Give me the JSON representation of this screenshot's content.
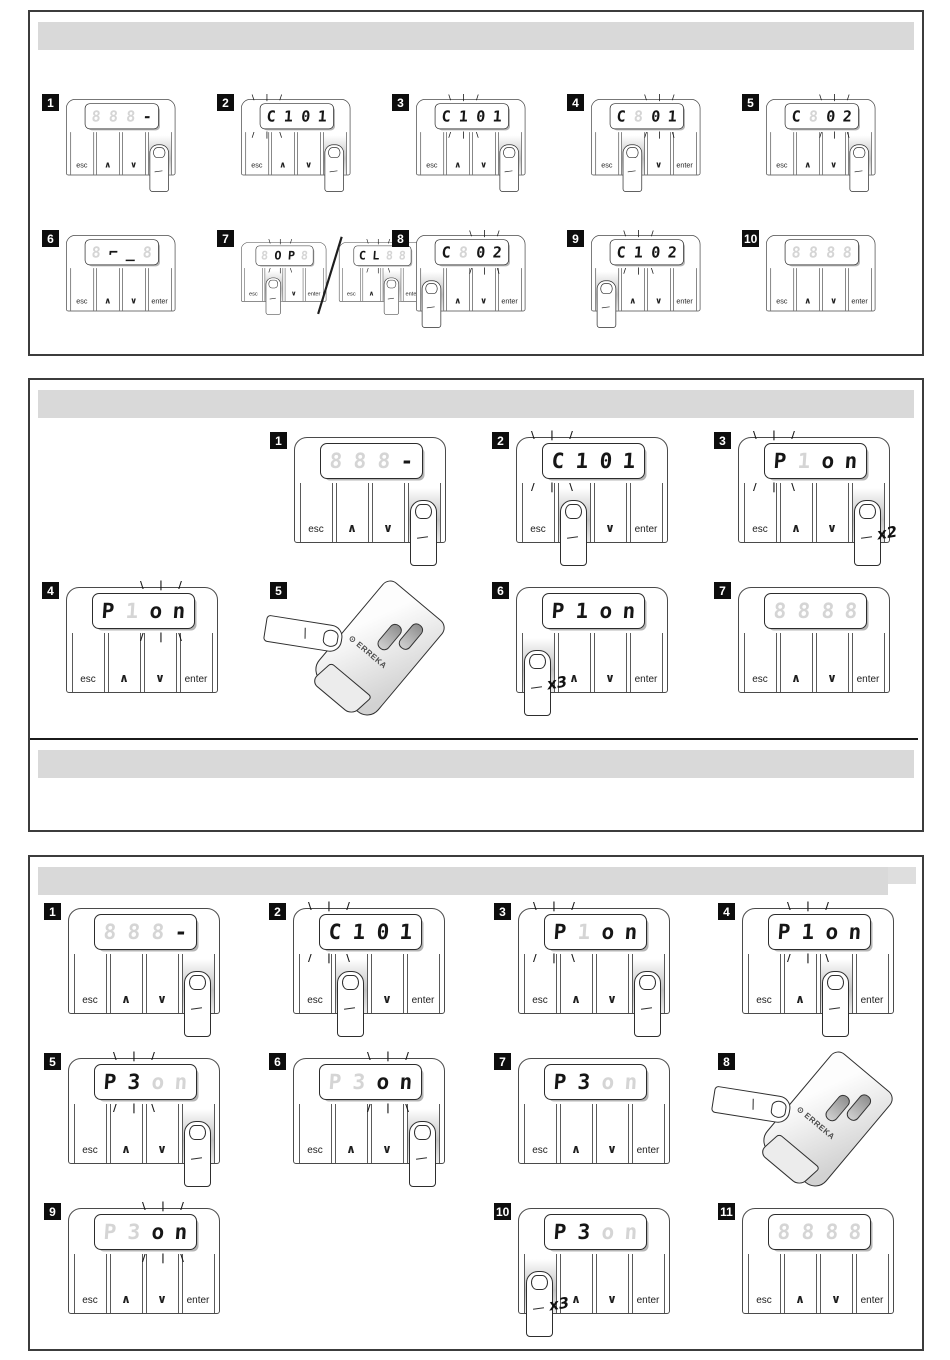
{
  "page": {
    "background": "#ffffff",
    "header_bar_color": "#d9d9d9"
  },
  "device": {
    "button_labels": [
      "esc",
      "∧",
      "∨",
      "enter"
    ],
    "ghost_char": "8"
  },
  "glyphs": {
    "rays_top": "\\ | /",
    "rays_bottom": "/ | \\",
    "pair_separator": "/"
  },
  "remote": {
    "brand": "ERREKA",
    "logo_mark": "⊙"
  },
  "sections": [
    {
      "name": "section-1",
      "header_label": "",
      "rows": [
        [
          {
            "num": "1",
            "col": 0,
            "type": "device",
            "cells": [
              "~8",
              "~8",
              "~8",
              "-"
            ],
            "blink": "none",
            "press": 3,
            "finger": true,
            "note": ""
          },
          {
            "num": "2",
            "col": 1,
            "type": "device",
            "cells": [
              "C",
              "1",
              "0",
              "1"
            ],
            "blink": "left",
            "press": 3,
            "finger": true,
            "note": ""
          },
          {
            "num": "3",
            "col": 2,
            "type": "device",
            "cells": [
              "C",
              "1",
              "0",
              "1"
            ],
            "blink": "c1",
            "press": 3,
            "finger": true,
            "note": ""
          },
          {
            "num": "4",
            "col": 3,
            "type": "device",
            "cells": [
              "C",
              "~8",
              "0",
              "1"
            ],
            "blink": "c23",
            "press": 1,
            "finger": true,
            "note": ""
          },
          {
            "num": "5",
            "col": 4,
            "type": "device",
            "cells": [
              "C",
              "~8",
              "0",
              "2"
            ],
            "blink": "c23",
            "press": 3,
            "finger": true,
            "note": ""
          }
        ],
        [
          {
            "num": "6",
            "col": 0,
            "type": "device",
            "cells": [
              "~8",
              "⌐",
              "_",
              "~8"
            ],
            "blink": "none",
            "press": -1,
            "finger": false,
            "note": ""
          },
          {
            "num": "7",
            "col": 1,
            "type": "pair",
            "pair": [
              {
                "cells": [
                  "~8",
                  "O",
                  "P",
                  "~8"
                ],
                "blink": "all",
                "press": 1,
                "finger": true,
                "note": ""
              },
              {
                "cells": [
                  "C",
                  "L",
                  "~8",
                  "~8"
                ],
                "blink": "all",
                "press": 2,
                "finger": true,
                "note": ""
              }
            ]
          },
          {
            "num": "8",
            "col": 2,
            "type": "device",
            "cells": [
              "C",
              "~8",
              "0",
              "2"
            ],
            "blink": "c23",
            "press": 0,
            "finger": true,
            "note": ""
          },
          {
            "num": "9",
            "col": 3,
            "type": "device",
            "cells": [
              "C",
              "1",
              "0",
              "2"
            ],
            "blink": "c1",
            "press": 0,
            "finger": true,
            "note": ""
          },
          {
            "num": "10",
            "col": 4,
            "type": "device",
            "cells": [
              "~8",
              "~8",
              "~8",
              "~8"
            ],
            "blink": "none",
            "press": -1,
            "finger": false,
            "note": ""
          }
        ]
      ]
    },
    {
      "name": "section-2",
      "header_label": "",
      "footer_rule": true,
      "footer_header_label": "",
      "rows": [
        [
          {
            "num": "1",
            "col": 1,
            "type": "device",
            "cells": [
              "~8",
              "~8",
              "~8",
              "-"
            ],
            "blink": "none",
            "press": 3,
            "finger": true,
            "note": ""
          },
          {
            "num": "2",
            "col": 2,
            "type": "device",
            "cells": [
              "C",
              "1",
              "0",
              "1"
            ],
            "blink": "left",
            "press": 1,
            "finger": true,
            "note": ""
          },
          {
            "num": "3",
            "col": 3,
            "type": "device",
            "cells": [
              "P",
              "~1",
              "o",
              "n"
            ],
            "blink": "c0",
            "press": 3,
            "finger": true,
            "note": "x2"
          }
        ],
        [
          {
            "num": "4",
            "col": 0,
            "type": "device",
            "cells": [
              "P",
              "~1",
              "o",
              "n"
            ],
            "blink": "c23",
            "press": -1,
            "finger": false,
            "note": ""
          },
          {
            "num": "5",
            "col": 1,
            "type": "remote"
          },
          {
            "num": "6",
            "col": 2,
            "type": "device",
            "cells": [
              "P",
              "1",
              "o",
              "n"
            ],
            "blink": "none",
            "press": 0,
            "finger": true,
            "note": "x3"
          },
          {
            "num": "7",
            "col": 3,
            "type": "device",
            "cells": [
              "~8",
              "~8",
              "~8",
              "~8"
            ],
            "blink": "none",
            "press": -1,
            "finger": false,
            "note": ""
          }
        ]
      ]
    },
    {
      "name": "section-3",
      "header_label": "",
      "header_notch": true,
      "rows": [
        [
          {
            "num": "1",
            "col": 0,
            "type": "device",
            "cells": [
              "~8",
              "~8",
              "~8",
              "-"
            ],
            "blink": "none",
            "press": 3,
            "finger": true,
            "note": ""
          },
          {
            "num": "2",
            "col": 1,
            "type": "device",
            "cells": [
              "C",
              "1",
              "0",
              "1"
            ],
            "blink": "left",
            "press": 1,
            "finger": true,
            "note": ""
          },
          {
            "num": "3",
            "col": 2,
            "type": "device",
            "cells": [
              "P",
              "~1",
              "o",
              "n"
            ],
            "blink": "c0",
            "press": 3,
            "finger": true,
            "note": ""
          },
          {
            "num": "4",
            "col": 3,
            "type": "device",
            "cells": [
              "P",
              "1",
              "o",
              "n"
            ],
            "blink": "c1",
            "press": 2,
            "finger": true,
            "note": ""
          }
        ],
        [
          {
            "num": "5",
            "col": 0,
            "type": "device",
            "cells": [
              "P",
              "3",
              "~o",
              "~n"
            ],
            "blink": "c1",
            "press": 3,
            "finger": true,
            "note": ""
          },
          {
            "num": "6",
            "col": 1,
            "type": "device",
            "cells": [
              "~P",
              "~3",
              "o",
              "n"
            ],
            "blink": "c23",
            "press": 3,
            "finger": true,
            "note": ""
          },
          {
            "num": "7",
            "col": 2,
            "type": "device",
            "cells": [
              "P",
              "3",
              "~o",
              "~n"
            ],
            "blink": "none",
            "press": -1,
            "finger": false,
            "note": ""
          },
          {
            "num": "8",
            "col": 3,
            "type": "remote"
          }
        ],
        [
          {
            "num": "9",
            "col": 0,
            "type": "device",
            "cells": [
              "~P",
              "~3",
              "o",
              "n"
            ],
            "blink": "c23",
            "press": -1,
            "finger": false,
            "note": ""
          },
          {
            "num": "10",
            "col": 2,
            "type": "device",
            "cells": [
              "P",
              "3",
              "~o",
              "~n"
            ],
            "blink": "none",
            "press": 0,
            "finger": true,
            "note": "x3"
          },
          {
            "num": "11",
            "col": 3,
            "type": "device",
            "cells": [
              "~8",
              "~8",
              "~8",
              "~8"
            ],
            "blink": "none",
            "press": -1,
            "finger": false,
            "note": ""
          }
        ]
      ]
    }
  ]
}
